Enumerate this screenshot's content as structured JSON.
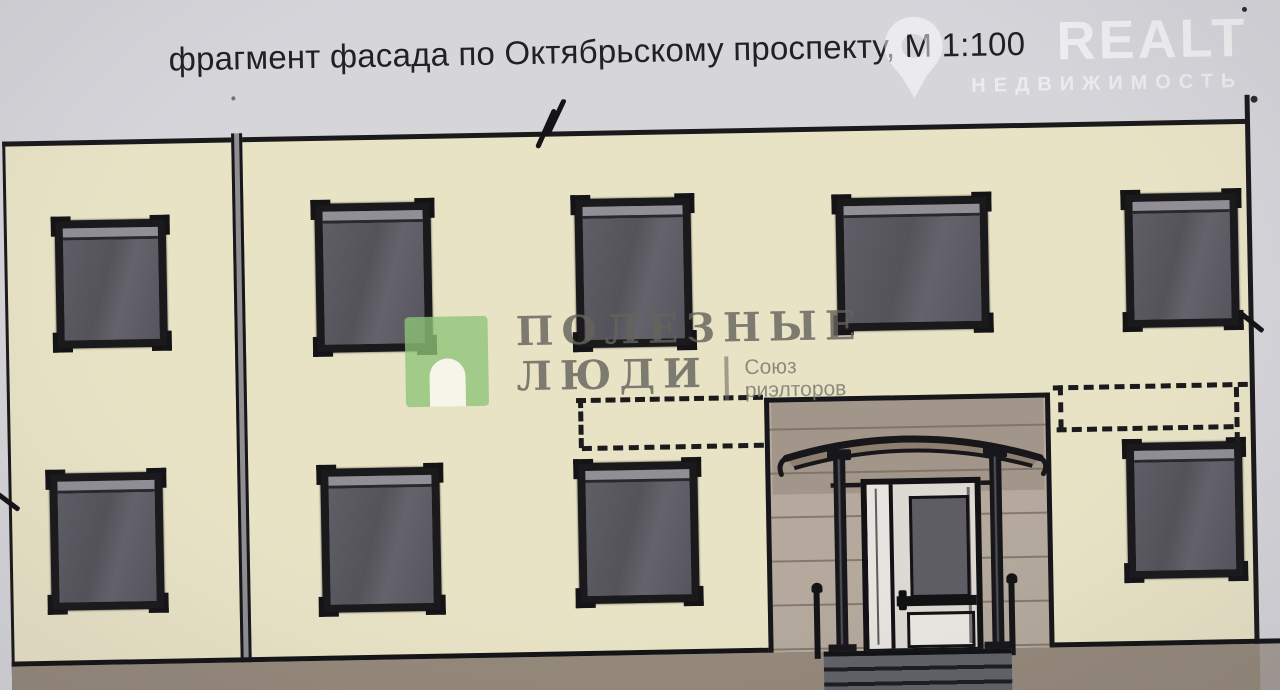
{
  "title": {
    "text": "фрагмент фасада по Октябрьскому проспекту, М 1:100"
  },
  "drawing": {
    "type": "architectural-facade-sketch",
    "subject": "Фрагмент фасада по Октябрьскому проспекту",
    "scale": "М 1:100",
    "colors": {
      "paper": "#d6d5da",
      "wall": "#e9e3c6",
      "ink": "#1a191b",
      "window_glass": "#585760",
      "entrance_portal": "#b4a99c",
      "ground": "#95897b",
      "steps": "#60626a"
    },
    "windows": [
      {
        "x": 77,
        "y": 230,
        "w": 111,
        "h": 128
      },
      {
        "x": 337,
        "y": 218,
        "w": 116,
        "h": 149
      },
      {
        "x": 597,
        "y": 218,
        "w": 116,
        "h": 149
      },
      {
        "x": 858,
        "y": 222,
        "w": 152,
        "h": 133
      },
      {
        "x": 1147,
        "y": 223,
        "w": 113,
        "h": 134
      },
      {
        "x": 67,
        "y": 483,
        "w": 113,
        "h": 137
      },
      {
        "x": 338,
        "y": 483,
        "w": 119,
        "h": 144
      },
      {
        "x": 595,
        "y": 482,
        "w": 120,
        "h": 141
      },
      {
        "x": 1144,
        "y": 472,
        "w": 116,
        "h": 136
      }
    ],
    "entrance": {
      "canopy": "arched",
      "columns": 2,
      "door": "single leaf with sidelight",
      "steps": 3
    }
  },
  "watermarks": {
    "poleznye_lyudi": {
      "logo_icon": "arch-door-icon",
      "logo_color": "#8ec477",
      "line1": "ПОЛЕЗНЫЕ",
      "line2": "ЛЮДИ",
      "sub_line1": "Союз",
      "sub_line2": "риэлторов",
      "text_color": "#65635c"
    },
    "realt": {
      "icon": "map-pin-icon",
      "brand": "REALT",
      "subtitle": "НЕДВИЖИМОСТЬ",
      "color": "#ffffff"
    }
  }
}
